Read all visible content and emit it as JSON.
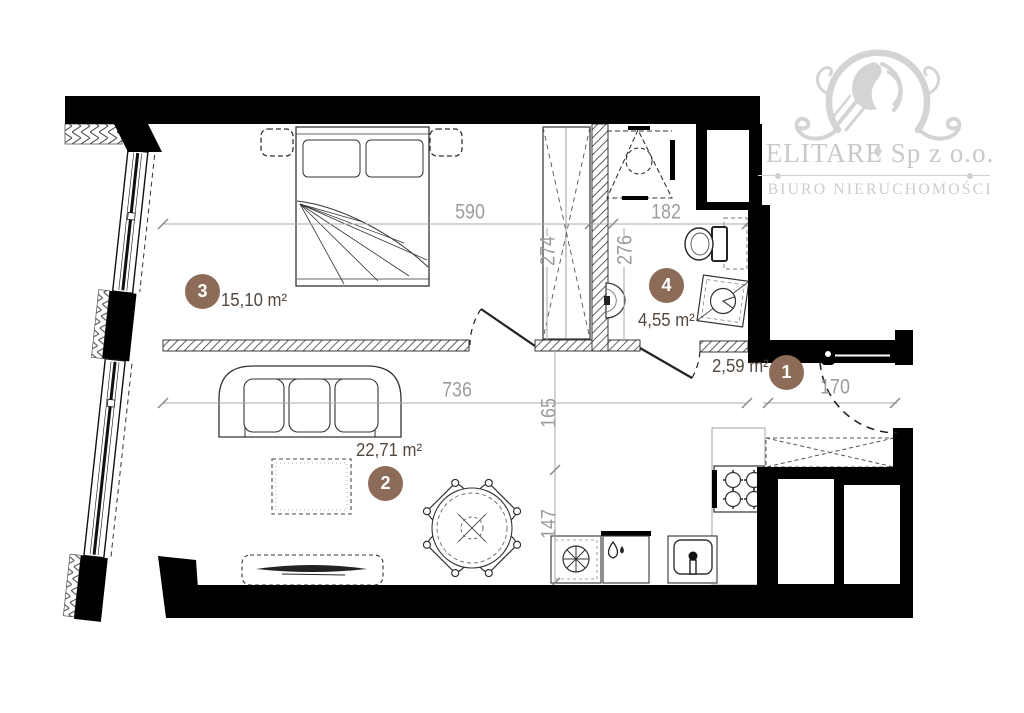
{
  "logo": {
    "company": "ELITARE Sp z o.o.",
    "tagline": "BIURO NIERUCHOMOŚCI"
  },
  "rooms": [
    {
      "number": "1",
      "area": "2,59 m²"
    },
    {
      "number": "2",
      "area": "22,71 m²"
    },
    {
      "number": "3",
      "area": "15,10 m²"
    },
    {
      "number": "4",
      "area": "4,55 m²"
    }
  ],
  "dimensions": {
    "bedroom_width": "590",
    "bathroom_width": "182",
    "wardrobe_height": "274",
    "bathroom_height": "276",
    "living_width": "736",
    "hall_depth": "165",
    "kitchen_depth": "147",
    "entry_width": "170"
  },
  "colors": {
    "wall": "#000000",
    "accent": "#8c6c59",
    "dimension_text": "#9c9c9c",
    "area_text": "#55483e",
    "logo_gray": "#d2d2d2"
  }
}
